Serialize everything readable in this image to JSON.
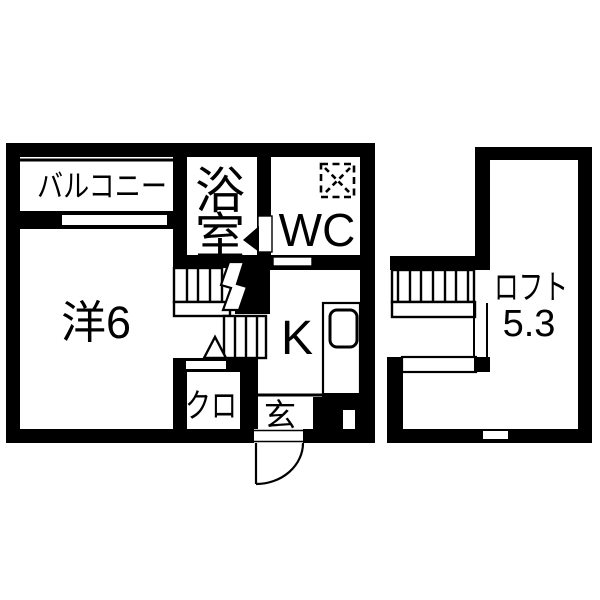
{
  "page": {
    "type": "floorplan",
    "background_color": "#ffffff",
    "ink_color": "#000000"
  },
  "floor1": {
    "rooms": {
      "balcony": {
        "label": "バルコニー"
      },
      "western_room": {
        "label": "洋6"
      },
      "bathroom": {
        "label": "浴室",
        "line1": "浴",
        "line2": "室"
      },
      "wc": {
        "label": "WC"
      },
      "kitchen": {
        "label": "K"
      },
      "closet": {
        "label": "クロ"
      },
      "entrance": {
        "label": "玄"
      }
    }
  },
  "loft": {
    "label": "ロフト",
    "size": "5.3"
  }
}
